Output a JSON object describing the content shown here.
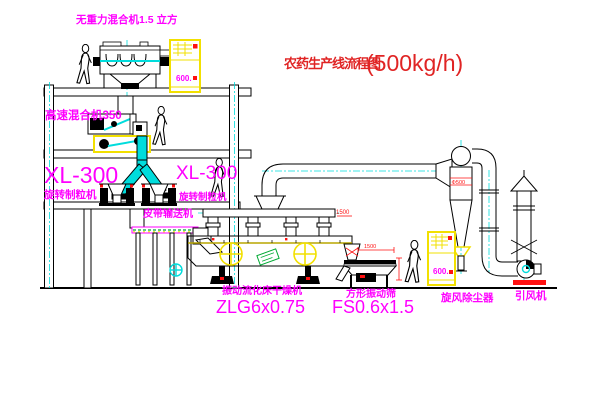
{
  "title": {
    "main": "农药生产线流程图",
    "capacity": "(500kg/h)"
  },
  "labels": {
    "top_mixer": "无重力混合机1.5 立方",
    "high_speed_mixer": "高速混合机350",
    "granulator_left_model": "XL-300",
    "granulator_left_name": "旋转制粒机",
    "granulator_right_model": "XL-300",
    "granulator_right_name": "旋转制粒机",
    "belt_conveyor": "皮带输送机",
    "dryer_name": "振动流化床干燥机",
    "dryer_model": "ZLG6x0.75",
    "sieve_name": "方形振动筛",
    "sieve_model": "FS0.6x1.5",
    "cyclone_name": "旋风除尘器",
    "fan_name": "引风机"
  },
  "annotations": {
    "cyclone_diameter": "Φ500",
    "dryer_dimension": "1500",
    "sieve_dimension": "1500",
    "cabinet_top_marking": "600.",
    "cabinet_ground_marking": "600."
  },
  "colors": {
    "title_red": "#e02424",
    "label_magenta": "#ff00ff",
    "equipment_yellow": "#f2e000",
    "centerline_cyan": "#00dcdc",
    "line_black": "#000000",
    "tag_green": "#00aa33",
    "dimension_red": "#ff0000",
    "background": "#ffffff"
  }
}
